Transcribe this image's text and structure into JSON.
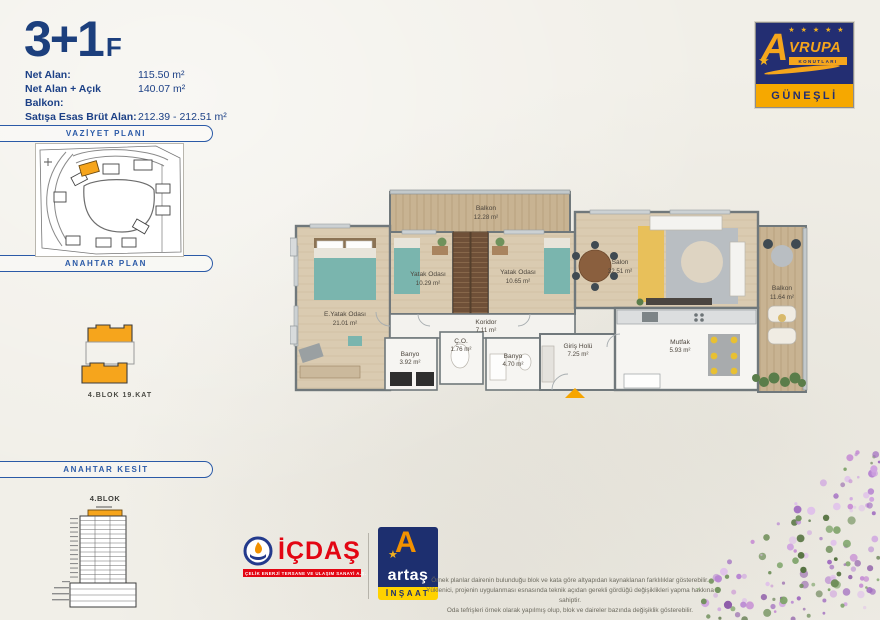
{
  "title": {
    "main": "3+1",
    "suffix": "F"
  },
  "specs": {
    "rows": [
      {
        "label": "Net Alan:",
        "value": "115.50 m²"
      },
      {
        "label": "Net Alan + Açık Balkon:",
        "value": "140.07 m²"
      },
      {
        "label": "Satışa Esas Brüt Alan:",
        "value": "212.39 - 212.51 m²"
      }
    ]
  },
  "sections": {
    "vaziyet_plani": "VAZİYET PLANI",
    "anahtar_plan": "ANAHTAR PLAN",
    "anahtar_kesit": "ANAHTAR KESİT"
  },
  "key_plan": {
    "caption": "4.BLOK 19.KAT"
  },
  "key_section": {
    "title": "4.BLOK"
  },
  "brand_logo": {
    "word": "VRUPA",
    "initial": "A",
    "sub": "KONUTLARI",
    "location": "GÜNEŞLİ",
    "stars": "★ ★ ★ ★ ★"
  },
  "plan": {
    "rooms": [
      {
        "name": "Balkon",
        "area": "12.28 m²"
      },
      {
        "name": "Salon",
        "area": "32.51 m²"
      },
      {
        "name": "Balkon",
        "area": "11.64 m²"
      },
      {
        "name": "E.Yatak Odası",
        "area": "21.01 m²"
      },
      {
        "name": "Yatak Odası",
        "area": "10.29 m²"
      },
      {
        "name": "Yatak Odası",
        "area": "10.65 m²"
      },
      {
        "name": "Koridor",
        "area": "7.11 m²"
      },
      {
        "name": "Banyo",
        "area": "3.92 m²"
      },
      {
        "name": "Ç.O.",
        "area": "1.76 m²"
      },
      {
        "name": "Banyo",
        "area": "4.70 m²"
      },
      {
        "name": "Giriş Holü",
        "area": "7.25 m²"
      },
      {
        "name": "Mutfak",
        "area": "5.93 m²"
      }
    ]
  },
  "footer_logos": {
    "icdas": {
      "name": "İÇDAŞ",
      "tagline": "ÇELİK ENERJİ TERSANE VE ULAŞIM SANAYİ A.Ş."
    },
    "artas": {
      "name": "artaş",
      "division": "İNŞAAT"
    }
  },
  "disclaimer": {
    "line1": "Örnek planlar dairenin bulunduğu blok ve kata göre altyapıdan kaynaklanan farklılıklar gösterebilir.",
    "line2": "Yüklenici, projenin uygulanması esnasında teknik açıdan gerekli gördüğü değişiklikleri yapma hakkına sahiptir.",
    "line3": "Oda tefrişleri örnek olarak yapılmış olup, blok ve daireler bazında değişiklik gösterebilir."
  },
  "colors": {
    "navy": "#1c3f7d",
    "header_blue": "#2b5aa7",
    "accent_orange": "#f6a51c",
    "logo_navy": "#232e72",
    "icdas_red": "#e30613",
    "artas_yellow": "#ffd200"
  }
}
